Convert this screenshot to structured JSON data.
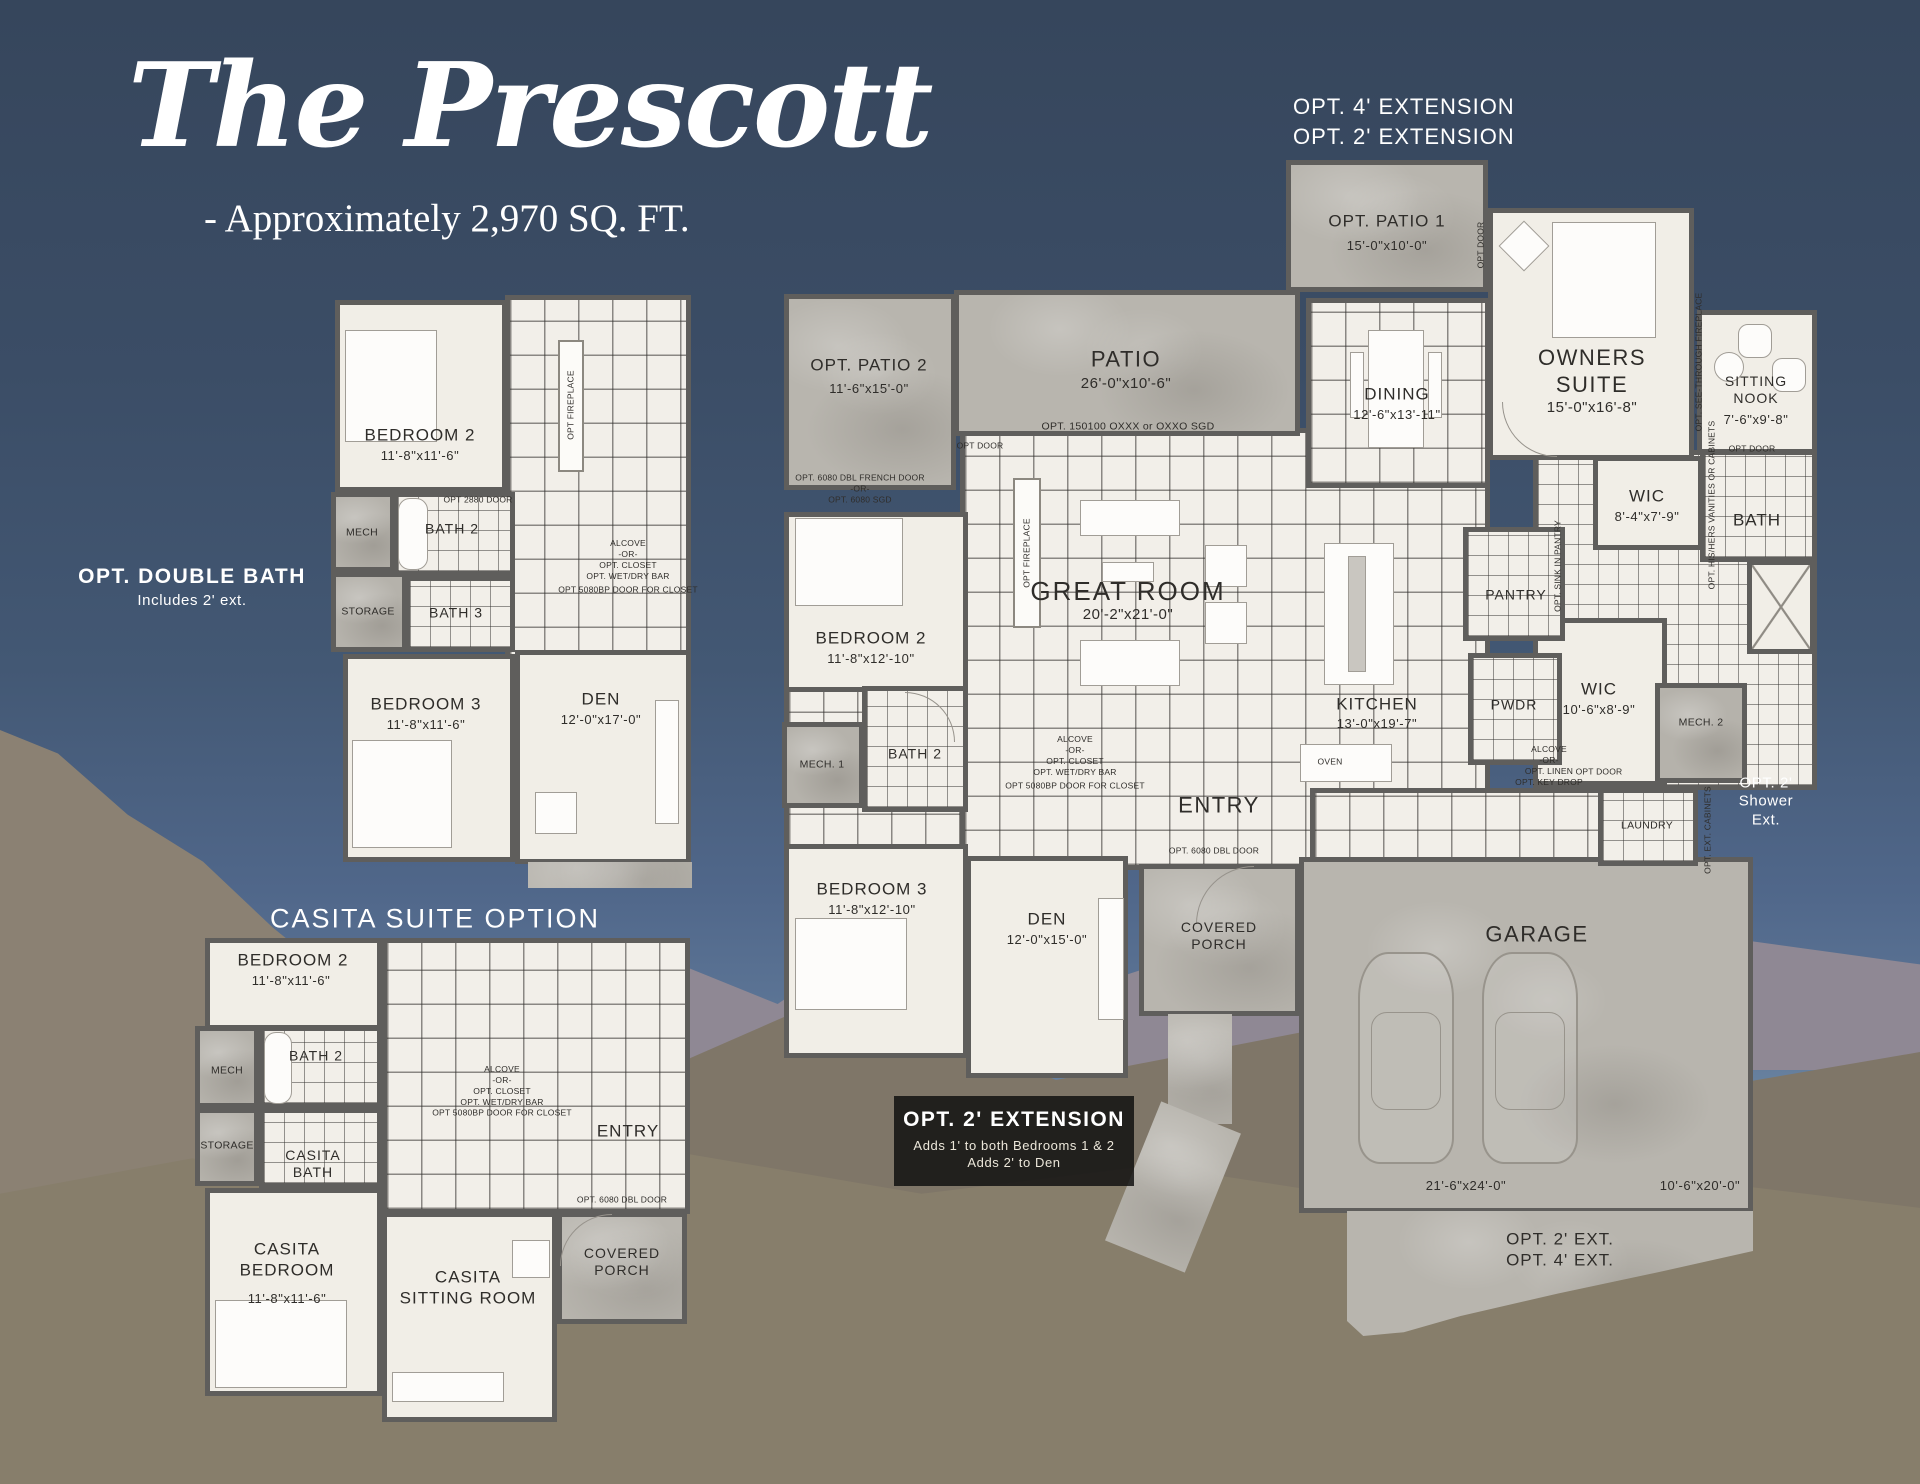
{
  "colors": {
    "sky_top": "#36465c",
    "sky_horizon": "#8fa6bc",
    "floor_cream": "#f1eee7",
    "wall": "#5f5e5c",
    "concrete": "#b8b5ae",
    "label_text": "#2f2d2a",
    "white_text": "#ffffff",
    "option_box_bg": "#0e0e0e"
  },
  "title": {
    "name": "The Prescott",
    "subtitle": "- Approximately 2,970 SQ. FT."
  },
  "main": {
    "ext_top": "OPT. 4' EXTENSION\nOPT. 2' EXTENSION",
    "opt_patio_1": {
      "name": "OPT. PATIO 1",
      "dims": "15'-0\"x10'-0\""
    },
    "opt_patio_2": {
      "name": "OPT. PATIO 2",
      "dims": "11'-6\"x15'-0\""
    },
    "patio": {
      "name": "PATIO",
      "dims": "26'-0\"x10'-6\""
    },
    "patio_door_note": "OPT. 150100 OXXX or OXXO SGD",
    "dining": {
      "name": "DINING",
      "dims": "12'-6\"x13'-11\""
    },
    "owners_suite": {
      "name": "OWNERS\nSUITE",
      "dims": "15'-0\"x16'-8\""
    },
    "sitting_nook": {
      "name": "SITTING\nNOOK",
      "dims": "7'-6\"x9'-8\""
    },
    "see_through_fireplace_note": "OPT. SEE-THROUGH FIREPLACE",
    "opt_door": "OPT DOOR",
    "wic1": {
      "name": "WIC",
      "dims": "8'-4\"x7'-9\""
    },
    "bath_owners": {
      "name": "BATH"
    },
    "vanities_note": "OPT. HIS/HERS VANITIES OR CABINETS",
    "great_room": {
      "name": "GREAT ROOM",
      "dims": "20'-2\"x21'-0\""
    },
    "opt_fireplace_note": "OPT FIREPLACE",
    "french_door_note": "OPT. 6080 DBL FRENCH DOOR\n-OR-\nOPT. 6080 SGD",
    "bedroom2": {
      "name": "BEDROOM 2",
      "dims": "11'-8\"x12'-10\""
    },
    "mech1": {
      "name": "MECH. 1"
    },
    "bath2": {
      "name": "BATH 2"
    },
    "bedroom3": {
      "name": "BEDROOM 3",
      "dims": "11'-8\"x12'-10\""
    },
    "den": {
      "name": "DEN",
      "dims": "12'-0\"x15'-0\""
    },
    "kitchen": {
      "name": "KITCHEN",
      "dims": "13'-0\"x19'-7\""
    },
    "oven": "OVEN",
    "pantry": {
      "name": "PANTRY"
    },
    "pantry_sink_note": "OPT. SINK IN PANTRY",
    "pwdr": {
      "name": "PWDR"
    },
    "wic2": {
      "name": "WIC",
      "dims": "10'-6\"x8'-9\""
    },
    "alcove_linen_note": "ALCOVE\n-OR-\nOPT. LINEN\nOPT. KEY DROP",
    "mech2": {
      "name": "MECH. 2"
    },
    "laundry": {
      "name": "LAUNDRY"
    },
    "ext_cabinets_note": "OPT. EXT. CABINETS",
    "shower_ext_note": "OPT. 2'\nShower\nExt.",
    "entry": {
      "name": "ENTRY"
    },
    "alcove_closet_note": "ALCOVE\n-OR-\nOPT. CLOSET\nOPT. WET/DRY BAR",
    "closet_door_note": "OPT 5080BP DOOR FOR CLOSET",
    "dbl_door_note": "OPT. 6080 DBL DOOR",
    "covered_porch": {
      "name": "COVERED\nPORCH"
    },
    "garage": {
      "name": "GARAGE",
      "bay_large_dims": "21'-6\"x24'-0\"",
      "bay_small_dims": "10'-6\"x20'-0\""
    },
    "driveway_note": "OPT. 2' EXT.\nOPT. 4' EXT.",
    "ext_box": {
      "title": "OPT. 2' EXTENSION",
      "line1": "Adds 1' to both Bedrooms 1 & 2",
      "line2": "Adds 2' to Den"
    }
  },
  "double_bath": {
    "label": "OPT. DOUBLE BATH",
    "sublabel": "Includes 2' ext.",
    "bedroom2": {
      "name": "BEDROOM 2",
      "dims": "11'-8\"x11'-6\""
    },
    "mech": {
      "name": "MECH"
    },
    "storage": {
      "name": "STORAGE"
    },
    "bath2": {
      "name": "BATH 2"
    },
    "bath3": {
      "name": "BATH 3"
    },
    "bedroom3": {
      "name": "BEDROOM 3",
      "dims": "11'-8\"x11'-6\""
    },
    "den": {
      "name": "DEN",
      "dims": "12'-0\"x17'-0\""
    },
    "opt_fireplace_note": "OPT FIREPLACE",
    "door_note": "OPT 2880 DOOR",
    "alcove_closet_note": "ALCOVE\n-OR-\nOPT. CLOSET\nOPT. WET/DRY BAR",
    "closet_door_note": "OPT 5080BP DOOR FOR CLOSET"
  },
  "casita": {
    "label": "CASITA SUITE OPTION",
    "bedroom2": {
      "name": "BEDROOM 2",
      "dims": "11'-8\"x11'-6\""
    },
    "mech": {
      "name": "MECH"
    },
    "storage": {
      "name": "STORAGE"
    },
    "bath2": {
      "name": "BATH 2"
    },
    "casita_bath": {
      "name": "CASITA\nBATH"
    },
    "casita_bedroom": {
      "name": "CASITA\nBEDROOM",
      "dims": "11'-8\"x11'-6\""
    },
    "casita_sitting": {
      "name": "CASITA\nSITTING ROOM"
    },
    "entry": {
      "name": "ENTRY"
    },
    "covered_porch": {
      "name": "COVERED\nPORCH"
    },
    "alcove_closet_note": "ALCOVE\n-OR-\nOPT. CLOSET\nOPT. WET/DRY BAR",
    "closet_door_note": "OPT 5080BP DOOR FOR CLOSET",
    "dbl_door_note": "OPT. 6080 DBL DOOR"
  }
}
